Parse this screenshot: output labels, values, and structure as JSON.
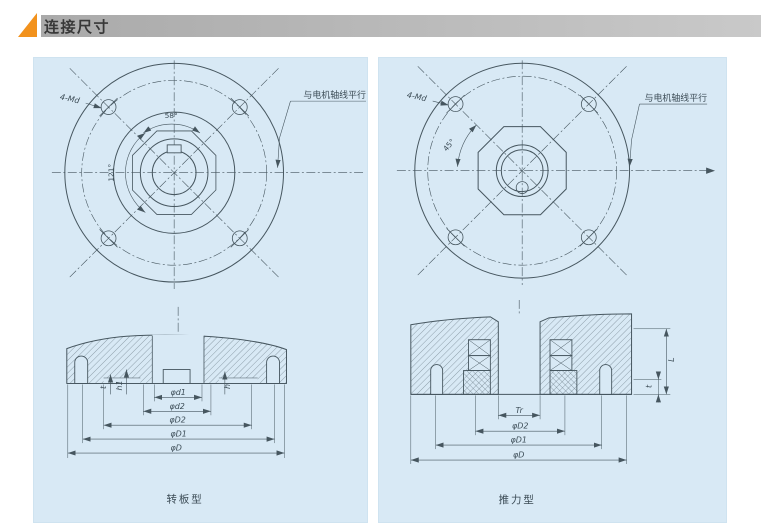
{
  "header": {
    "title": "连接尺寸"
  },
  "colors": {
    "panel_bg": "#d8e9f5",
    "line": "#46565f",
    "header_bar_left": "#aaaaaa",
    "header_bar_right": "#c9c9c9",
    "accent_orange": "#f2921d",
    "title_text": "#383838"
  },
  "left_panel": {
    "flange": {
      "bolt_label": "4-Md",
      "angle_top": "58°",
      "angle_side": "121°",
      "leader_note": "与电机轴线平行"
    },
    "section": {
      "dims": [
        "φd1",
        "φd2",
        "φD2",
        "φD1",
        "φD"
      ],
      "vdims": [
        "t",
        "h1",
        "h"
      ]
    },
    "caption": "转板型"
  },
  "right_panel": {
    "flange": {
      "bolt_label": "4-Md",
      "angle_side": "45°",
      "leader_note": "与电机轴线平行"
    },
    "section": {
      "dims": [
        "Tr",
        "φD2",
        "φD1",
        "φD"
      ],
      "vdims": [
        "L",
        "t"
      ]
    },
    "caption": "推力型"
  }
}
